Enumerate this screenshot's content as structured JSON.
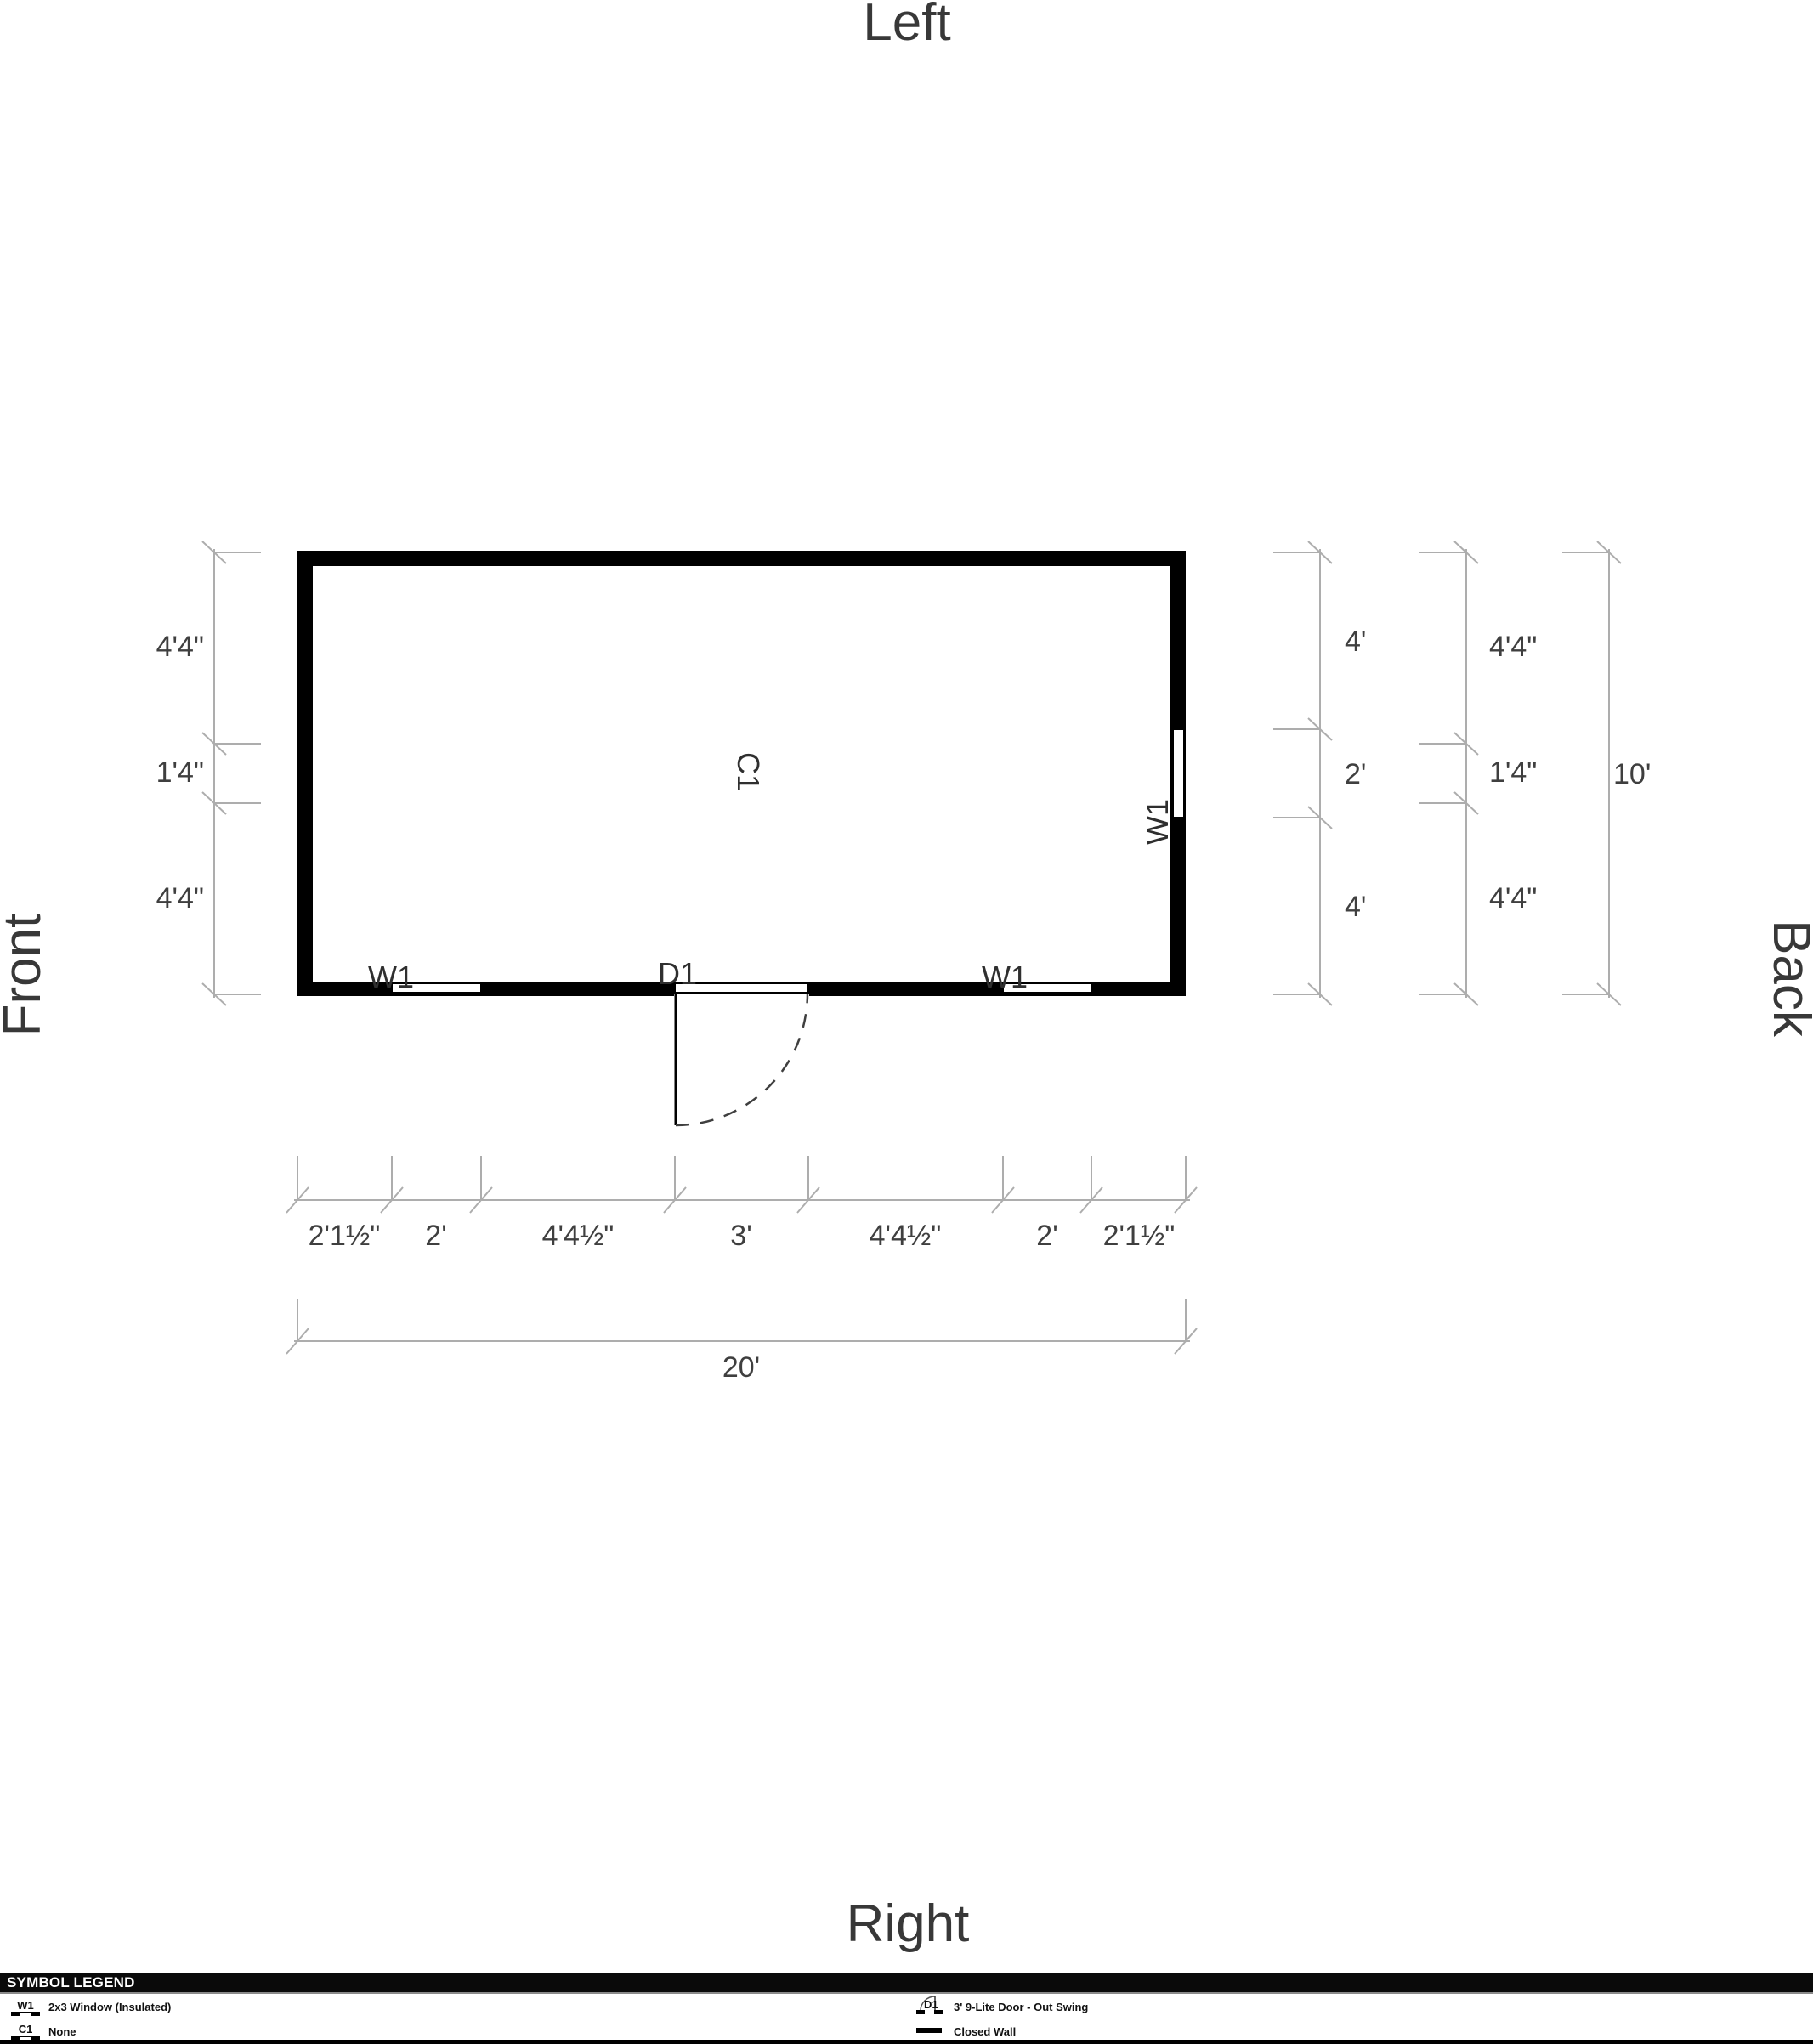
{
  "orientation_labels": {
    "top": "Left",
    "bottom": "Right",
    "left": "Front",
    "right": "Back"
  },
  "plan": {
    "room_label": "C1",
    "window_label": "W1",
    "door_label": "D1"
  },
  "dimensions": {
    "left_side": [
      "4'4\"",
      "1'4\"",
      "4'4\""
    ],
    "right_inner": [
      "4'",
      "2'",
      "4'"
    ],
    "right_middle": [
      "4'4\"",
      "1'4\"",
      "4'4\""
    ],
    "right_total": "10'",
    "bottom_segments": [
      "2'1½\"",
      "2'",
      "4'4½\"",
      "3'",
      "4'4½\"",
      "2'",
      "2'1½\""
    ],
    "bottom_total": "20'"
  },
  "legend": {
    "title": "SYMBOL LEGEND",
    "items": [
      {
        "symbol": "W1",
        "description": "2x3 Window (Insulated)"
      },
      {
        "symbol": "C1",
        "description": "None"
      },
      {
        "symbol": "D1",
        "description": "3' 9-Lite Door - Out Swing"
      },
      {
        "symbol": "closed-wall",
        "description": "Closed Wall"
      }
    ]
  },
  "colors": {
    "wall": "#000000",
    "dimension_line": "#adadad",
    "dimension_text": "#3f3f3f",
    "label_text": "#2f2f2f"
  }
}
